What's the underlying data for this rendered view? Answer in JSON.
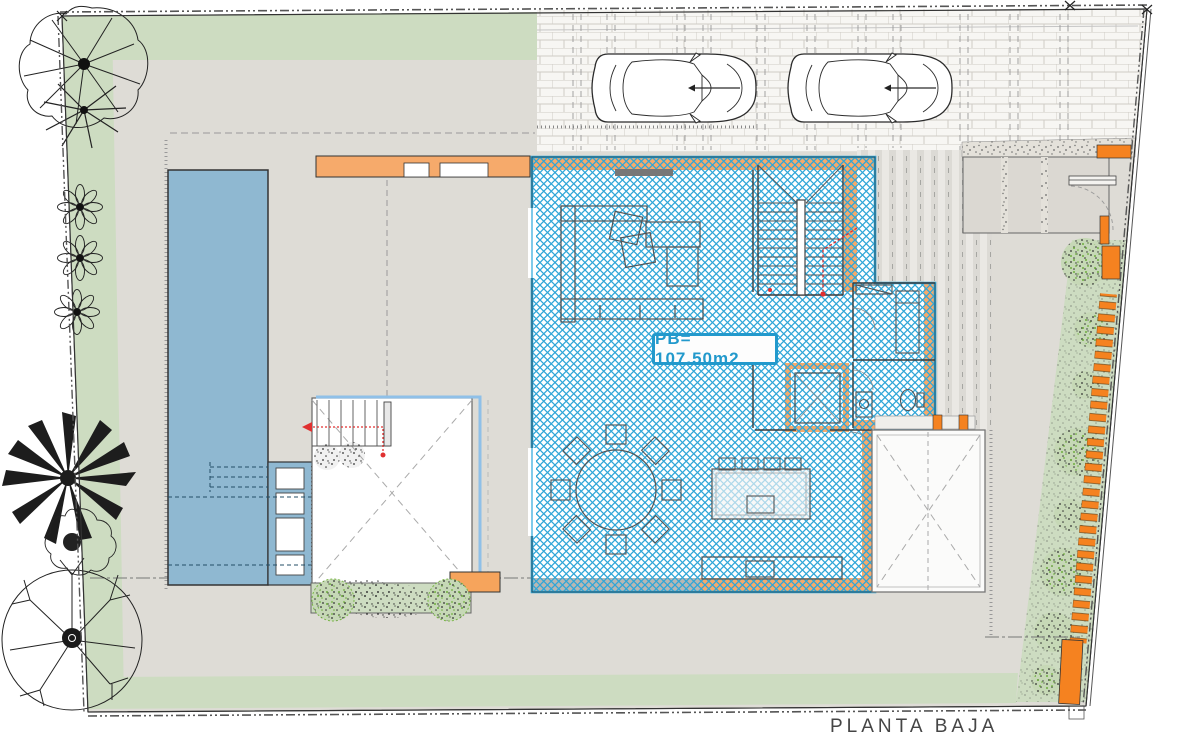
{
  "drawing": {
    "title": "PLANTA BAJA",
    "area_label": "PB= 107.50m2"
  },
  "colors": {
    "floor_hatch_blue": "#2FA6D8",
    "house_border_blue": "#2AA7DC",
    "wall_orange": "#F6AA6B",
    "gate_orange": "#F58220",
    "pool_blue": "#8FB8D1",
    "vegetation_green": "#CDDCC1",
    "plot_gray": "#DEDCD6",
    "egress_red": "#E03030",
    "label_text_blue": "#2299CC",
    "title_text_gray": "#454545"
  }
}
